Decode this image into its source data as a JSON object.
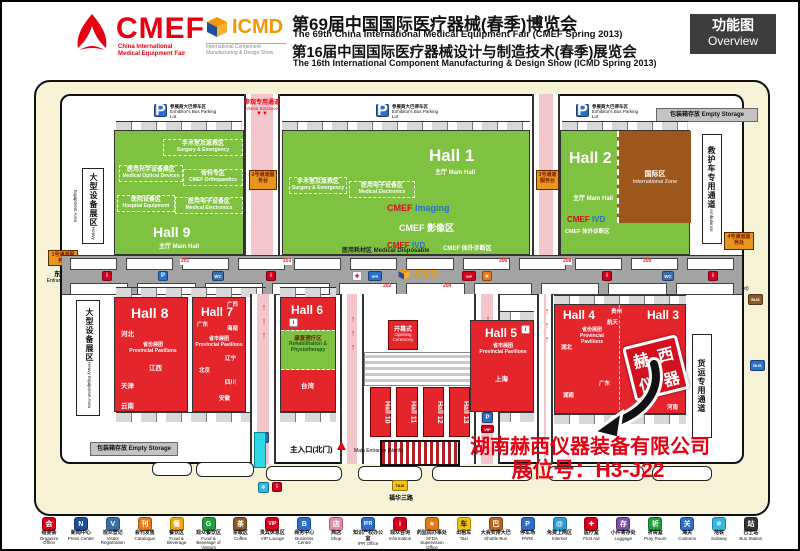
{
  "colors": {
    "hall_green": "#7fc241",
    "hall_red": "#e5252c",
    "intl_brown": "#9c571c",
    "accent_red": "#e60012",
    "cream": "#f6f2d6",
    "corridor_gray": "#a3a3a3",
    "cyan": "#2fd8e2"
  },
  "header": {
    "cmef": {
      "logo": "CMEF",
      "tag1": "China International",
      "tag2": "Medical Equipment Fair"
    },
    "icmd": {
      "logo": "ICMD",
      "tag1": "International Component",
      "tag2": "Manufacturing & Design Show"
    },
    "title_zh1": "第69届中国国际医疗器械(春季)博览会",
    "title_en1": "The 69th China International Medical Equipment Fair (CMEF Spring 2013)",
    "title_zh2": "第16届中国国际医疗器械设计与制造技术(春季)展览会",
    "title_en2": "The 16th International Component Manufacturing & Design Show (ICMD Spring 2013)",
    "overview_zh": "功能图",
    "overview_en": "Overview"
  },
  "icons": {
    "info": "i",
    "parking": "P",
    "wc": "WC",
    "ipr": "IPR",
    "vip": "VIP",
    "star": "★",
    "cross": "✚",
    "subway": "❄",
    "at": "@",
    "taxi": "TAXI",
    "bus": "BUS",
    "arrow_right": "▶",
    "arrow_left": "◀",
    "arrow_up": "▲",
    "down_pair": "▼▼",
    "ramp_arrows": "↑↑↑",
    "badge": "▣"
  },
  "map": {
    "parking_zh": "参展商大巴停车区",
    "parking_en": "Exhibitor's Bus Parking Lot",
    "empty_storage": "包装箱存放 Empty Storage",
    "visitor_channel_zh": "参观专用通道",
    "visitor_channel_en": "Visitor Entrance",
    "heavy_zh": "大型设备展区",
    "heavy_en": "Heavy Equipment Area",
    "ambulance_zh": "救护车专用通道",
    "ambulance_en": "Ambulance",
    "freight_zh": "货运专用通道",
    "east_zh": "东门入口",
    "east_en": "Entrance(East)",
    "west_zh": "西门入口",
    "west_en": "Entrance(West)",
    "main_zh": "主入口(北门)",
    "main_en": "Main Entrance (North)",
    "street": "福华三路",
    "desk_left": "1号通道服务处",
    "desk_right": "4号通道服务处",
    "desk_c1": "2号通道服务台",
    "desk_c2": "3号通道服务台",
    "disposable": "医用耗材区 Medical Disposable",
    "icmd_logo": "ICMD",
    "rooms": {
      "r201": "201",
      "r203": "203",
      "r206": "206",
      "r208": "208",
      "r209": "209",
      "r202": "202",
      "r204": "204"
    },
    "opening_zh": "开幕式",
    "opening_en": "Opening Ceremony",
    "halls": {
      "h9": {
        "name": "Hall 9",
        "sub": "主厅 Main Hall",
        "zones": [
          {
            "zh": "手术室及急救区",
            "en": "Surgery & Emergency"
          },
          {
            "zh": "医用光学设备展区",
            "en": "Medical Optical Devices"
          },
          {
            "zh": "骨科专区",
            "en": "CMEF Orthopaedics"
          },
          {
            "zh": "医院设备区",
            "en": "Hospital Equipment"
          },
          {
            "zh": "医用电子设备区",
            "en": "Medical Electronics"
          }
        ]
      },
      "h1": {
        "name": "Hall 1",
        "sub": "主厅 Main Hall",
        "img_a": "CMEF",
        "img_b": "Imaging",
        "imaging_zone": "CMEF 影像区",
        "ivd_a": "CMEF",
        "ivd_b": "IVD",
        "ivd_zone": "CMEF 体外诊断区",
        "zones": [
          {
            "zh": "手术室及急救区",
            "en": "Surgery & Emergency"
          },
          {
            "zh": "医用电子设备区",
            "en": "Medical Electronics"
          }
        ]
      },
      "h2": {
        "name": "Hall 2",
        "sub": "主厅 Main Hall",
        "intl_zh": "国际区",
        "intl_en": "International Zone",
        "ivd_a": "CMEF",
        "ivd_b": "IVD",
        "ivd_zone": "CMEF 体外诊断区"
      },
      "h8": {
        "name": "Hall 8",
        "pav_zh": "省份展团",
        "pav_en": "Provincial Pavilions",
        "provinces": [
          "河北",
          "江西",
          "天津",
          "云南"
        ]
      },
      "h7": {
        "name": "Hall 7",
        "pav_zh": "省市展团",
        "pav_en": "Provincial Pavilions",
        "provinces": [
          "广西",
          "广东",
          "海南",
          "辽宁",
          "北京",
          "四川",
          "安徽"
        ]
      },
      "h6": {
        "name": "Hall 6",
        "rehab_zh": "康复理疗区",
        "rehab_en": "Rehabilitation & Physiotherapy",
        "provinces": [
          "台湾"
        ]
      },
      "h5": {
        "name": "Hall 5",
        "pav_zh": "省市展团",
        "pav_en": "Provincial Pavilions",
        "provinces": [
          "上海"
        ]
      },
      "h4": {
        "name": "Hall 4",
        "pav_zh": "省份展团",
        "pav_en": "Provincial Pavilions",
        "provinces": [
          "贵州",
          "航天",
          "湖北",
          "广东",
          "湖南"
        ]
      },
      "h3": {
        "name": "Hall 3",
        "provinces": [
          "浙江",
          "黑龙江",
          "南京",
          "江西",
          "河南"
        ]
      },
      "center": [
        "Hall 10",
        "Hall 11",
        "Hall 12",
        "Hall 13"
      ]
    }
  },
  "annotation": {
    "company": "湖南赫西仪器装备有限公司",
    "booth": "展位号：H3-J22",
    "seal": [
      "赫",
      "西",
      "仪",
      "器"
    ]
  },
  "legend": {
    "items": [
      {
        "zh": "组委会",
        "en": "Organize Office",
        "glyph": "会",
        "color": "#d6001c"
      },
      {
        "zh": "新闻中心",
        "en": "Press Center",
        "glyph": "N",
        "color": "#1f4e9c"
      },
      {
        "zh": "观众登记",
        "en": "Visitor Registration",
        "glyph": "V",
        "color": "#3a6ea5"
      },
      {
        "zh": "会刊发售",
        "en": "Catalogue",
        "glyph": "刊",
        "color": "#e77817"
      },
      {
        "zh": "餐饮区",
        "en": "Food & Beverage",
        "glyph": "餐",
        "color": "#f0a80a"
      },
      {
        "zh": "观众餐饮区",
        "en": "Food & Beverage of Visitors",
        "glyph": "G",
        "color": "#1f9e3c"
      },
      {
        "zh": "茶歇区",
        "en": "Coffee",
        "glyph": "茶",
        "color": "#8a5a2b"
      },
      {
        "zh": "贵宾休息区",
        "en": "VIP Lounge",
        "glyph": "VIP",
        "color": "#d6001c"
      },
      {
        "zh": "商务中心",
        "en": "Business Centre",
        "glyph": "B",
        "color": "#2a6fc9"
      },
      {
        "zh": "商店",
        "en": "Shop",
        "glyph": "店",
        "color": "#e88aa0"
      },
      {
        "zh": "知识产权办公室",
        "en": "IPR Office",
        "glyph": "IPR",
        "color": "#2a6fc9"
      },
      {
        "zh": "观众咨询",
        "en": "Information",
        "glyph": "i",
        "color": "#d6001c"
      },
      {
        "zh": "药监局办事处",
        "en": "SFDA Supervision Office",
        "glyph": "★",
        "color": "#e77817"
      },
      {
        "zh": "出租车",
        "en": "Taxi",
        "glyph": "车",
        "color": "#f4c20d"
      },
      {
        "zh": "大会安排大巴",
        "en": "Shuttle Bus",
        "glyph": "巴",
        "color": "#b5651d"
      },
      {
        "zh": "停车场",
        "en": "PARK",
        "glyph": "P",
        "color": "#2a6fc9"
      },
      {
        "zh": "免费上网区",
        "en": "Internet",
        "glyph": "@",
        "color": "#2a9fd6"
      },
      {
        "zh": "医疗室",
        "en": "First Aid",
        "glyph": "✚",
        "color": "#d6001c"
      },
      {
        "zh": "小件寄存处",
        "en": "Luggage",
        "glyph": "存",
        "color": "#7b4fa6"
      },
      {
        "zh": "祈祷室",
        "en": "Pray Room",
        "glyph": "祈",
        "color": "#1f9e3c"
      },
      {
        "zh": "海关",
        "en": "Customs",
        "glyph": "关",
        "color": "#2a6fc9"
      },
      {
        "zh": "地铁",
        "en": "Subway",
        "glyph": "❄",
        "color": "#35b8e0"
      },
      {
        "zh": "巴士站",
        "en": "Bus Station",
        "glyph": "站",
        "color": "#333333"
      }
    ]
  }
}
